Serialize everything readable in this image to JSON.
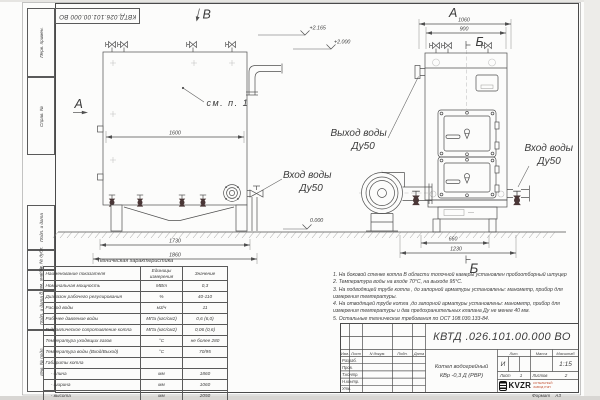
{
  "frame": {
    "stamp_top": "КВТД.026.101.00.000  ВО",
    "format_label": "Формат",
    "format_value": "А3",
    "margin_boxes": [
      "Перв. примен.",
      "Справ. №",
      "Подп. и дата",
      "Инв. № дубл.",
      "Взам. инв. №",
      "Подп. и дата",
      "Инв. № подл."
    ]
  },
  "drawing": {
    "view_front_label": "В",
    "section_a_left": "А",
    "view_side_label": "А",
    "section_b_top": "Б",
    "section_b_bottom": "Б",
    "callout_note": "см. п. 1",
    "outlet_label": "Выход воды",
    "outlet_dn": "Ду50",
    "inlet_front_label": "Вход воды",
    "inlet_front_dn": "Ду50",
    "inlet_side_label": "Вход воды",
    "inlet_side_dn": "Ду50",
    "elev_top": "+2.165",
    "elev_mid": "+2.000",
    "elev_zero": "0.000",
    "dims": {
      "w1600": "1600",
      "w1730": "1730",
      "w1860": "1860",
      "d1060": "1060",
      "d900": "900",
      "d660": "660",
      "d1230": "1230"
    }
  },
  "spec_table": {
    "title": "Техническая характеристика",
    "headers": [
      "Наименование показателя",
      "Единицы измерения",
      "Значение"
    ],
    "rows": [
      [
        "Номинальная мощность",
        "МВт",
        "0,3"
      ],
      [
        "Диапазон рабочего регулирования",
        "%",
        "40-110"
      ],
      [
        "Расход воды",
        "м3/ч",
        "11"
      ],
      [
        "Рабочее давление воды",
        "МПа (кгс/см2)",
        "0,6 (6,0)"
      ],
      [
        "Гидравлическое сопротивление котла",
        "МПа (кгс/см2)",
        "0,06 (0,6)"
      ],
      [
        "Температура уходящих газов",
        "°С",
        "не более 280"
      ],
      [
        "Температура воды (Вход/Выход)",
        "°С",
        "70/95"
      ],
      [
        "Габариты котла",
        "",
        ""
      ],
      [
        "    - длина",
        "мм",
        "1860"
      ],
      [
        "    - ширина",
        "мм",
        "1060"
      ],
      [
        "    - высота",
        "мм",
        "2050"
      ]
    ]
  },
  "notes": {
    "lines": [
      "1.  На боковой стенке котла В области топочной камеры установлен пробоотборный штуцер",
      "2.  Температура воды на входе  70°С,  на выходе  95°С.",
      "3.  На подводящей трубе котла , до запорной арматуры установлены:  манометр, прибор для",
      "измерения температуры.",
      "4.  На отводящей трубе котла ,до запорной арматуры установлены:  манометр, прибор для",
      "измерения температуры и два предохранительных клапана  Ду не менее  40 мм.",
      "5.  Остальные технические требования по ОСТ  108.030.133-84."
    ]
  },
  "title_block": {
    "designation": "КВТД .026.101.00.000  ВО",
    "name_line1": "Котел водогрейный",
    "name_line2": "КВр -0,3  Д  (РВР)",
    "header_cells": [
      "Изм.",
      "Лист",
      "N докум.",
      "Подп.",
      "Дата"
    ],
    "sign_rows": [
      "Разраб.",
      "Пров.",
      "Т.контр.",
      "Н.контр.",
      "Утв."
    ],
    "lit_label": "Лит.",
    "mass_label": "Масса",
    "scale_label": "Масштаб",
    "lit_value": "И",
    "scale_value": "1:15",
    "sheet_label": "Лист",
    "sheet_value": "1",
    "sheets_label": "Листов",
    "sheets_value": "2",
    "logo_text": "KVZR",
    "logo_line1": "КОТЕЛЬНЫЙ",
    "logo_line2": "ЗАВОД РЭП",
    "accent_red": "#c14a2b"
  }
}
